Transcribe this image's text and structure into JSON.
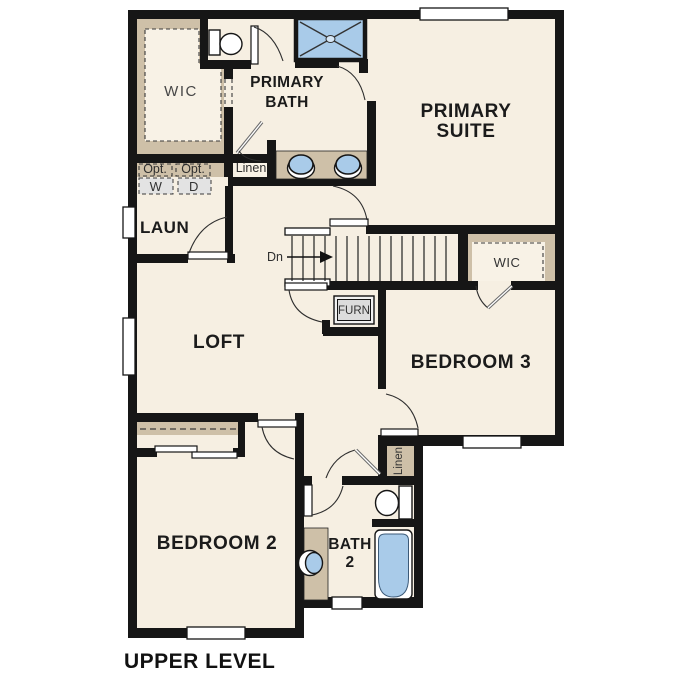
{
  "plan_title": "UPPER LEVEL",
  "colors": {
    "floor": "#f6efe2",
    "wall": "#161616",
    "closet_tan": "#cec0a8",
    "fixture_blue": "#a9cbe9",
    "appliance_gray": "#e3e3e3",
    "window_white": "#ffffff"
  },
  "rooms": {
    "primary_bath": {
      "line1": "PRIMARY",
      "line2": "BATH"
    },
    "primary_suite": {
      "line1": "PRIMARY",
      "line2": "SUITE"
    },
    "loft": {
      "label": "LOFT"
    },
    "laundry": {
      "label": "LAUN"
    },
    "bedroom3": {
      "label": "BEDROOM 3"
    },
    "bedroom2": {
      "label": "BEDROOM 2"
    },
    "bath2": {
      "line1": "BATH",
      "line2": "2"
    }
  },
  "closets": {
    "wic_primary": "WIC",
    "wic_hall": "WIC",
    "linen_hall": "Linen",
    "linen_bath": "Linen"
  },
  "laundry_appliances": {
    "washer_opt": "Opt.",
    "dryer_opt": "Opt.",
    "washer": "W",
    "dryer": "D"
  },
  "stairs": {
    "down_label": "Dn"
  },
  "utility": {
    "furnace": "FURN"
  }
}
